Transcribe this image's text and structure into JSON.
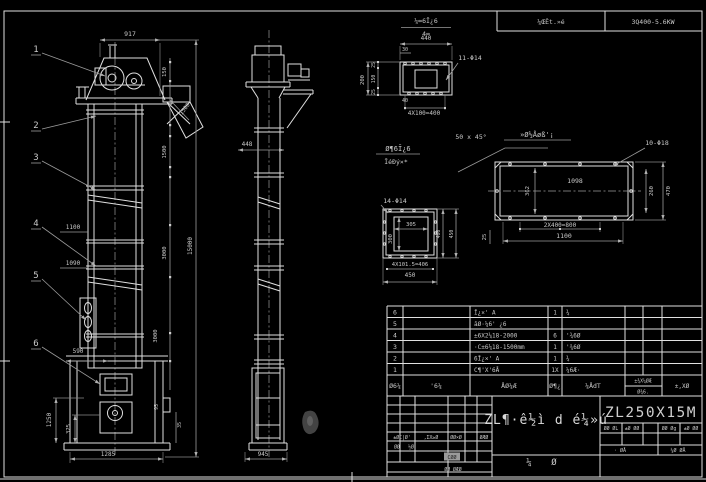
{
  "header": {
    "frac_top": "¼∞6Ī¿6",
    "frac_bottom": "4∞",
    "cell1": "¼ŒÊt.»é",
    "cell2": "3Q400-5.6KW"
  },
  "front": {
    "d917": "917",
    "b1": "1",
    "b2": "2",
    "b3": "3",
    "b4": "4",
    "b5": "5",
    "b6": "6",
    "d1100": "1100",
    "d1090": "1090",
    "d590": "590",
    "d1250": "1250",
    "d325": "325",
    "d1285": "1285",
    "d150": "150",
    "d1500d": "1500",
    "d1500": "1500",
    "d3000a": "3000",
    "d3000b": "3000",
    "d15000": "15000",
    "d95": "95",
    "d35": "35"
  },
  "side": {
    "d448": "448",
    "d945": "945"
  },
  "d1": {
    "d440": "440",
    "d30": "30",
    "d200": "200",
    "d25a": "25",
    "d150": "150",
    "d25b": "25",
    "holes": "11-Φ14",
    "d40": "40",
    "d4x100": "4X100=400",
    "cap1": "Ø¶6Ī¿6",
    "cap2": "ĪéÐý×*",
    "chamfer": "50 x 45°"
  },
  "d2": {
    "title": "»Ø½Åøß'¡",
    "holes": "10-Φ18",
    "d1098": "1098",
    "d362": "362",
    "d260": "260",
    "d470": "470",
    "d2x400": "2X400=800",
    "d1100": "1100",
    "d25": "25"
  },
  "d3": {
    "holes": "14-Φ14",
    "d305": "305",
    "d300": "300",
    "d406": "406",
    "d450r": "450",
    "d4x101": "4X101.5=406",
    "d450b": "450"
  },
  "bom": {
    "header": [
      "Ø6¼",
      "'6¼",
      "ÅØ¼Æ",
      "Ø¶¿",
      "¼ÅdT",
      "±¾X¼ØÆ",
      "Ø¾6.",
      "±,XØ"
    ],
    "rows": [
      {
        "no": "6",
        "name": "Ī¿×' A",
        "qty": "1",
        "mat": "¾"
      },
      {
        "no": "5",
        "name": "āØ·¼6' ¿6",
        "qty": "",
        "mat": ""
      },
      {
        "no": "4",
        "name": "±6X2¼18-2000",
        "qty": "6",
        "mat": "'¾6Ø"
      },
      {
        "no": "3",
        "name": "·C±6¼18-1500mm",
        "qty": "1",
        "mat": "'¾6Ø"
      },
      {
        "no": "2",
        "name": "6Ī¿×' A",
        "qty": "1",
        "mat": "¾"
      },
      {
        "no": "1",
        "name": "C¶'X'6Å",
        "qty": "1X",
        "mat": "¼6Æ·"
      }
    ]
  },
  "tb": {
    "row1": [
      "±ØC|Ø'",
      ",ΣX≥Ø",
      "ØØ×Ø",
      "ØÆØ"
    ],
    "row2": [
      "ØØ",
      "½Ø"
    ],
    "sel": "CØØ",
    "stamp": "ØØ ØÆØ",
    "title": "ZL¶·ê½ì d é¼»ú",
    "sub1": "¼",
    "sub2": "Ø",
    "model": "ZL250X15M",
    "r1": [
      "ØØ ØL",
      "±Ø ØØ",
      "ØØ Øg",
      "±Ø ØØ"
    ],
    "sign1": "· ØÅ",
    "sign2": "¼Ø ØÅ"
  }
}
